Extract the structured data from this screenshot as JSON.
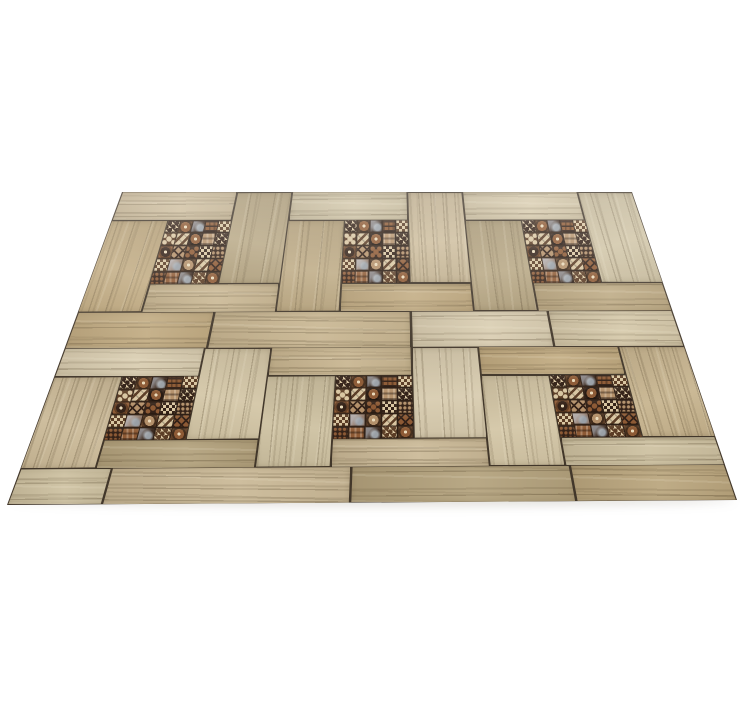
{
  "page": {
    "background": "#ffffff",
    "canvas_width": 752,
    "canvas_height": 703
  },
  "scene": {
    "description": "Six square wood-effect floor tiles with dark patchwork decor inlays, laid in a pinwheel parquet pattern and photographed in perspective on a white background",
    "rows": 2,
    "columns": 3,
    "quad": {
      "tl": [
        122,
        192
      ],
      "tr": [
        632,
        192
      ],
      "br": [
        737,
        500
      ],
      "bl": [
        7,
        505
      ]
    },
    "unit_pieces": [
      {
        "name": "top-plank",
        "u0": 0.0,
        "v0": 0.0,
        "u1": 0.68,
        "v1": 0.18,
        "grain": "h"
      },
      {
        "name": "right-plank",
        "u0": 0.68,
        "v0": 0.0,
        "u1": 1.0,
        "v1": 0.59,
        "grain": "v"
      },
      {
        "name": "decor-inlay",
        "u0": 0.32,
        "v0": 0.18,
        "u1": 0.68,
        "v1": 0.59,
        "grain": "decor"
      },
      {
        "name": "left-plank",
        "u0": 0.0,
        "v0": 0.18,
        "u1": 0.32,
        "v1": 0.77,
        "grain": "v"
      },
      {
        "name": "mid-plank",
        "u0": 0.32,
        "v0": 0.59,
        "u1": 1.0,
        "v1": 0.77,
        "grain": "h"
      }
    ],
    "bottom_band": {
      "v0": 0.77,
      "v1": 1.0,
      "joints_by_row": [
        [
          0.23,
          0.56,
          0.79
        ],
        [
          0.13,
          0.47,
          0.78
        ]
      ]
    },
    "decor_grid": {
      "size": 5,
      "cells": [
        [
          "hound:4:0",
          "medallion:1:2",
          "shine:0:6",
          "weave:2:0",
          "checker:4:1"
        ],
        [
          "floral:1:4",
          "zigzag:4:1",
          "medallion:0:2",
          "gingham:3:0",
          "hound:4:0"
        ],
        [
          "medallion:2:0",
          "diamond:3:0",
          "floral:0:2",
          "checker:4:0",
          "dots:0:3"
        ],
        [
          "checker:1:4",
          "shine:5:6",
          "medallion:1:3",
          "zigzag:4:1",
          "diamond:2:0"
        ],
        [
          "dots:0:2",
          "gingham:2:0",
          "shine:0:6",
          "hound:4:1",
          "medallion:1:2"
        ]
      ]
    },
    "colors": {
      "background": "#ffffff",
      "grout": "#42372a",
      "decor_base": "#2e1f15",
      "wood_tones": [
        "#c9b897",
        "#bda67c",
        "#d2c5a6",
        "#b1a07c",
        "#c5b28d",
        "#ccc0a1",
        "#b8a47d",
        "#d7cbaf"
      ],
      "wood_dark_streak": "rgba(82,67,42,",
      "wood_light_streak": "rgba(248,240,218,",
      "shadow": "rgba(90,75,55,0.18)",
      "haze_top": "rgba(255,255,255,0.22)"
    }
  }
}
